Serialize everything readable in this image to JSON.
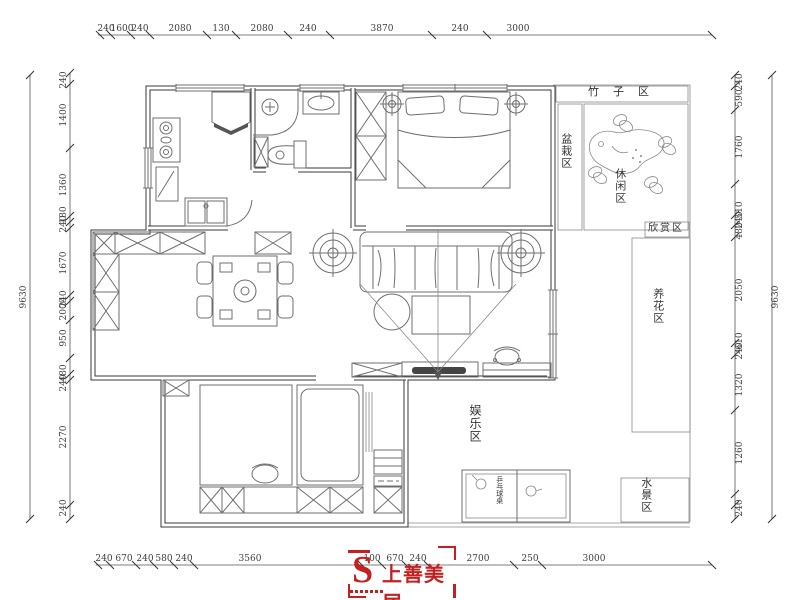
{
  "dims": {
    "top": [
      "240",
      "1600",
      "240",
      "2080",
      "130",
      "2080",
      "240",
      "3870",
      "240",
      "3000"
    ],
    "bottom": [
      "240",
      "670",
      "240",
      "580",
      "240",
      "3560",
      "100",
      "670",
      "240",
      "2700",
      "250",
      "3000"
    ],
    "left": [
      "240",
      "1400",
      "1360",
      "180",
      "240",
      "1670",
      "240",
      "2000",
      "950",
      "480",
      "240",
      "2270",
      "240"
    ],
    "right": [
      "240",
      "590",
      "1760",
      "510",
      "240",
      "480",
      "2050",
      "610",
      "240",
      "1320",
      "1260",
      "240"
    ],
    "left_total": "9630",
    "right_total": "9630"
  },
  "rooms": {
    "bamboo": "竹子区",
    "potted": "盆栽区",
    "leisure": "休闲区",
    "viewing": "欣赏区",
    "flower": "养花区",
    "water": "水景区",
    "entertainment": "娱乐区",
    "pingpong": "乒乓球桌"
  },
  "logo": {
    "monogram": "S",
    "brand": "上善美居",
    "color": "#c42020"
  }
}
